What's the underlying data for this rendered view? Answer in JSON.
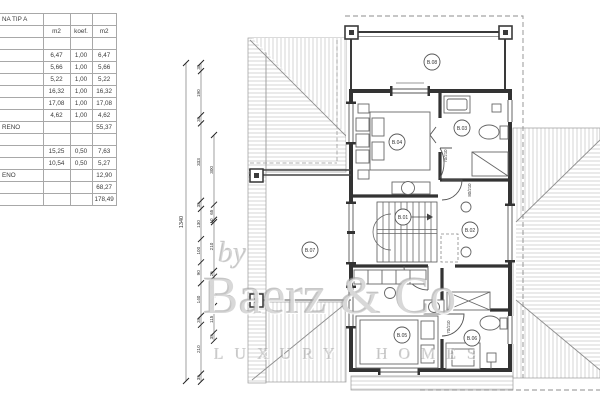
{
  "table": {
    "title_fragment": "NA TIP A",
    "columns": [
      "m2",
      "koef.",
      "m2"
    ],
    "rows": [
      {
        "label": "",
        "c1": "",
        "c2": "",
        "c3": ""
      },
      {
        "label": "",
        "c1": "6,47",
        "c2": "1,00",
        "c3": "6,47"
      },
      {
        "label": "",
        "c1": "5,66",
        "c2": "1,00",
        "c3": "5,66"
      },
      {
        "label": "",
        "c1": "5,22",
        "c2": "1,00",
        "c3": "5,22"
      },
      {
        "label": "",
        "c1": "16,32",
        "c2": "1,00",
        "c3": "16,32"
      },
      {
        "label": "",
        "c1": "17,08",
        "c2": "1,00",
        "c3": "17,08"
      },
      {
        "label": "",
        "c1": "4,62",
        "c2": "1,00",
        "c3": "4,62"
      },
      {
        "label": "RENO",
        "c1": "",
        "c2": "",
        "c3": "55,37"
      },
      {
        "label": "",
        "c1": "",
        "c2": "",
        "c3": ""
      },
      {
        "label": "",
        "c1": "15,25",
        "c2": "0,50",
        "c3": "7,63"
      },
      {
        "label": "",
        "c1": "10,54",
        "c2": "0,50",
        "c3": "5,27"
      },
      {
        "label": "ENO",
        "c1": "",
        "c2": "",
        "c3": "12,90"
      },
      {
        "label": "",
        "c1": "",
        "c2": "",
        "c3": "68,27"
      },
      {
        "label": "",
        "c1": "",
        "c2": "",
        "c3": "178,49"
      }
    ]
  },
  "watermark": {
    "by": "by",
    "brand": "Baerz & Co",
    "tagline": "LUXURY HOMES"
  },
  "plan": {
    "rooms": [
      {
        "id": "B.08",
        "x": 432,
        "y": 62
      },
      {
        "id": "B.04",
        "x": 397,
        "y": 142
      },
      {
        "id": "B.03",
        "x": 462,
        "y": 128
      },
      {
        "id": "B.01",
        "x": 403,
        "y": 217
      },
      {
        "id": "B.02",
        "x": 470,
        "y": 230
      },
      {
        "id": "B.07",
        "x": 310,
        "y": 250
      },
      {
        "id": "B.05",
        "x": 402,
        "y": 335
      },
      {
        "id": "B.06",
        "x": 472,
        "y": 338
      }
    ],
    "door_labels": [
      {
        "text": "70/210",
        "x": 447,
        "y": 156
      },
      {
        "text": "80/210",
        "x": 471,
        "y": 190
      },
      {
        "text": "70/210",
        "x": 450,
        "y": 327
      }
    ],
    "dimensions": {
      "overall": {
        "label": "1340",
        "x": 186,
        "y1": 63,
        "y2": 381
      },
      "scale": 0.2323,
      "chains": [
        {
          "x": 201,
          "start": 63,
          "values": [
            35,
            190,
            35,
            333,
            35,
            130,
            100,
            90,
            140,
            39,
            210,
            35
          ]
        },
        {
          "x": 214,
          "start": 135,
          "values": [
            300,
            65,
            10,
            210,
            25,
            90,
            36,
            115,
            35
          ]
        }
      ]
    }
  }
}
